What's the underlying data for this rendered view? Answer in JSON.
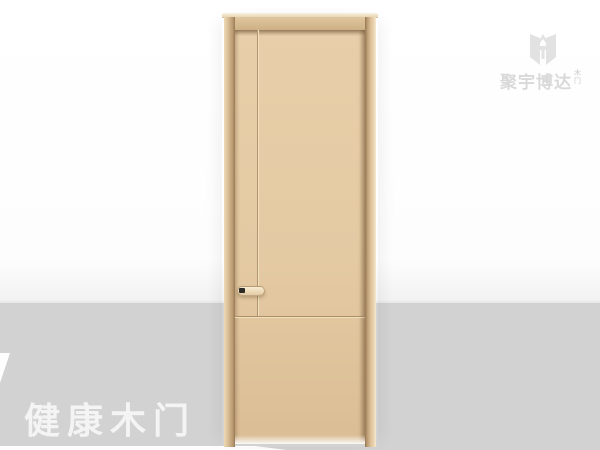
{
  "watermark": {
    "brand": "聚宇博达",
    "suffix_chars": [
      "木",
      "门"
    ],
    "color": "#d9d9d9",
    "icon": "brand-logo-icon"
  },
  "caption": {
    "text": "健康木门",
    "color": "#f4f4f4"
  },
  "colors": {
    "background_top": "#fdfdfd",
    "background_band": "#d2d2d2",
    "door_slab": "#e4caa3",
    "door_frame": "#d8bb93",
    "door_groove": "#b3966d",
    "handle_lock": "#2c2a24"
  }
}
